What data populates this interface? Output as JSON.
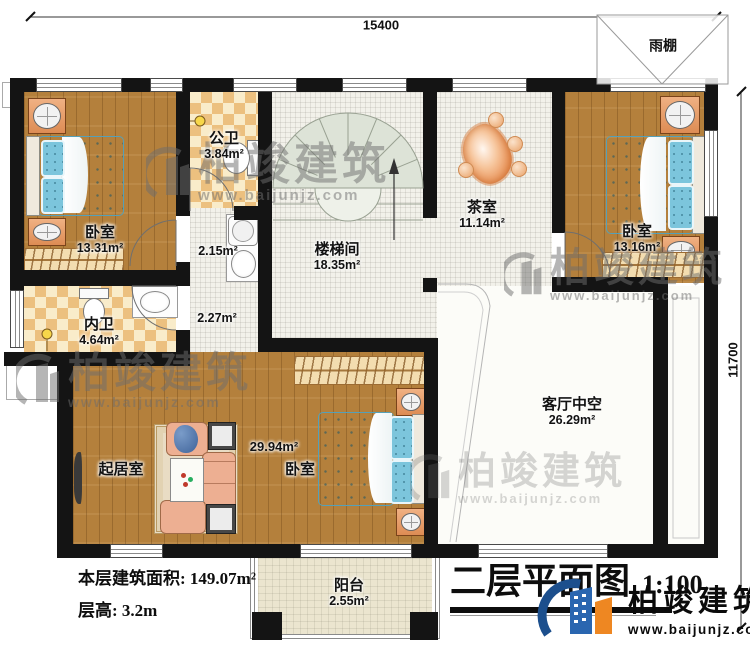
{
  "plan": {
    "title": "二层平面图",
    "scale": "1:100",
    "floor_area_label": "本层建筑面积: 149.07m²",
    "floor_height_label": "层高: 3.2m",
    "dim_top": "15400",
    "dim_right": "11700",
    "shared_area": "29.94m²"
  },
  "rooms": {
    "bedroom1": {
      "name": "卧室",
      "area": "13.31m²"
    },
    "public_bath": {
      "name": "公卫",
      "area": "3.84m²"
    },
    "stair_hall": {
      "name": "楼梯间",
      "area": "18.35m²"
    },
    "corridor_upper": {
      "area": "2.15m²"
    },
    "corridor_lower": {
      "area": "2.27m²"
    },
    "tea_room": {
      "name": "茶室",
      "area": "11.14m²"
    },
    "bedroom2": {
      "name": "卧室",
      "area": "13.16m²"
    },
    "master_bath": {
      "name": "内卫",
      "area": "4.64m²"
    },
    "living_void": {
      "name": "客厅中空",
      "area": "26.29m²"
    },
    "living_room": {
      "name": "起居室"
    },
    "bedroom3": {
      "name": "卧室"
    },
    "balcony": {
      "name": "阳台",
      "area": "2.55m²"
    },
    "canopy": {
      "name": "雨棚"
    }
  },
  "brand": {
    "name": "柏竣建筑",
    "url": "www.baijunjz.com"
  },
  "watermark": {
    "text": "柏竣建筑",
    "url": "www.baijunjz.com"
  },
  "colors": {
    "wall": "#141414",
    "wood": "#b4803c",
    "mattress": "#7cc5dc",
    "logo_blue": "#2a66b0",
    "logo_orange": "#ee8722"
  }
}
